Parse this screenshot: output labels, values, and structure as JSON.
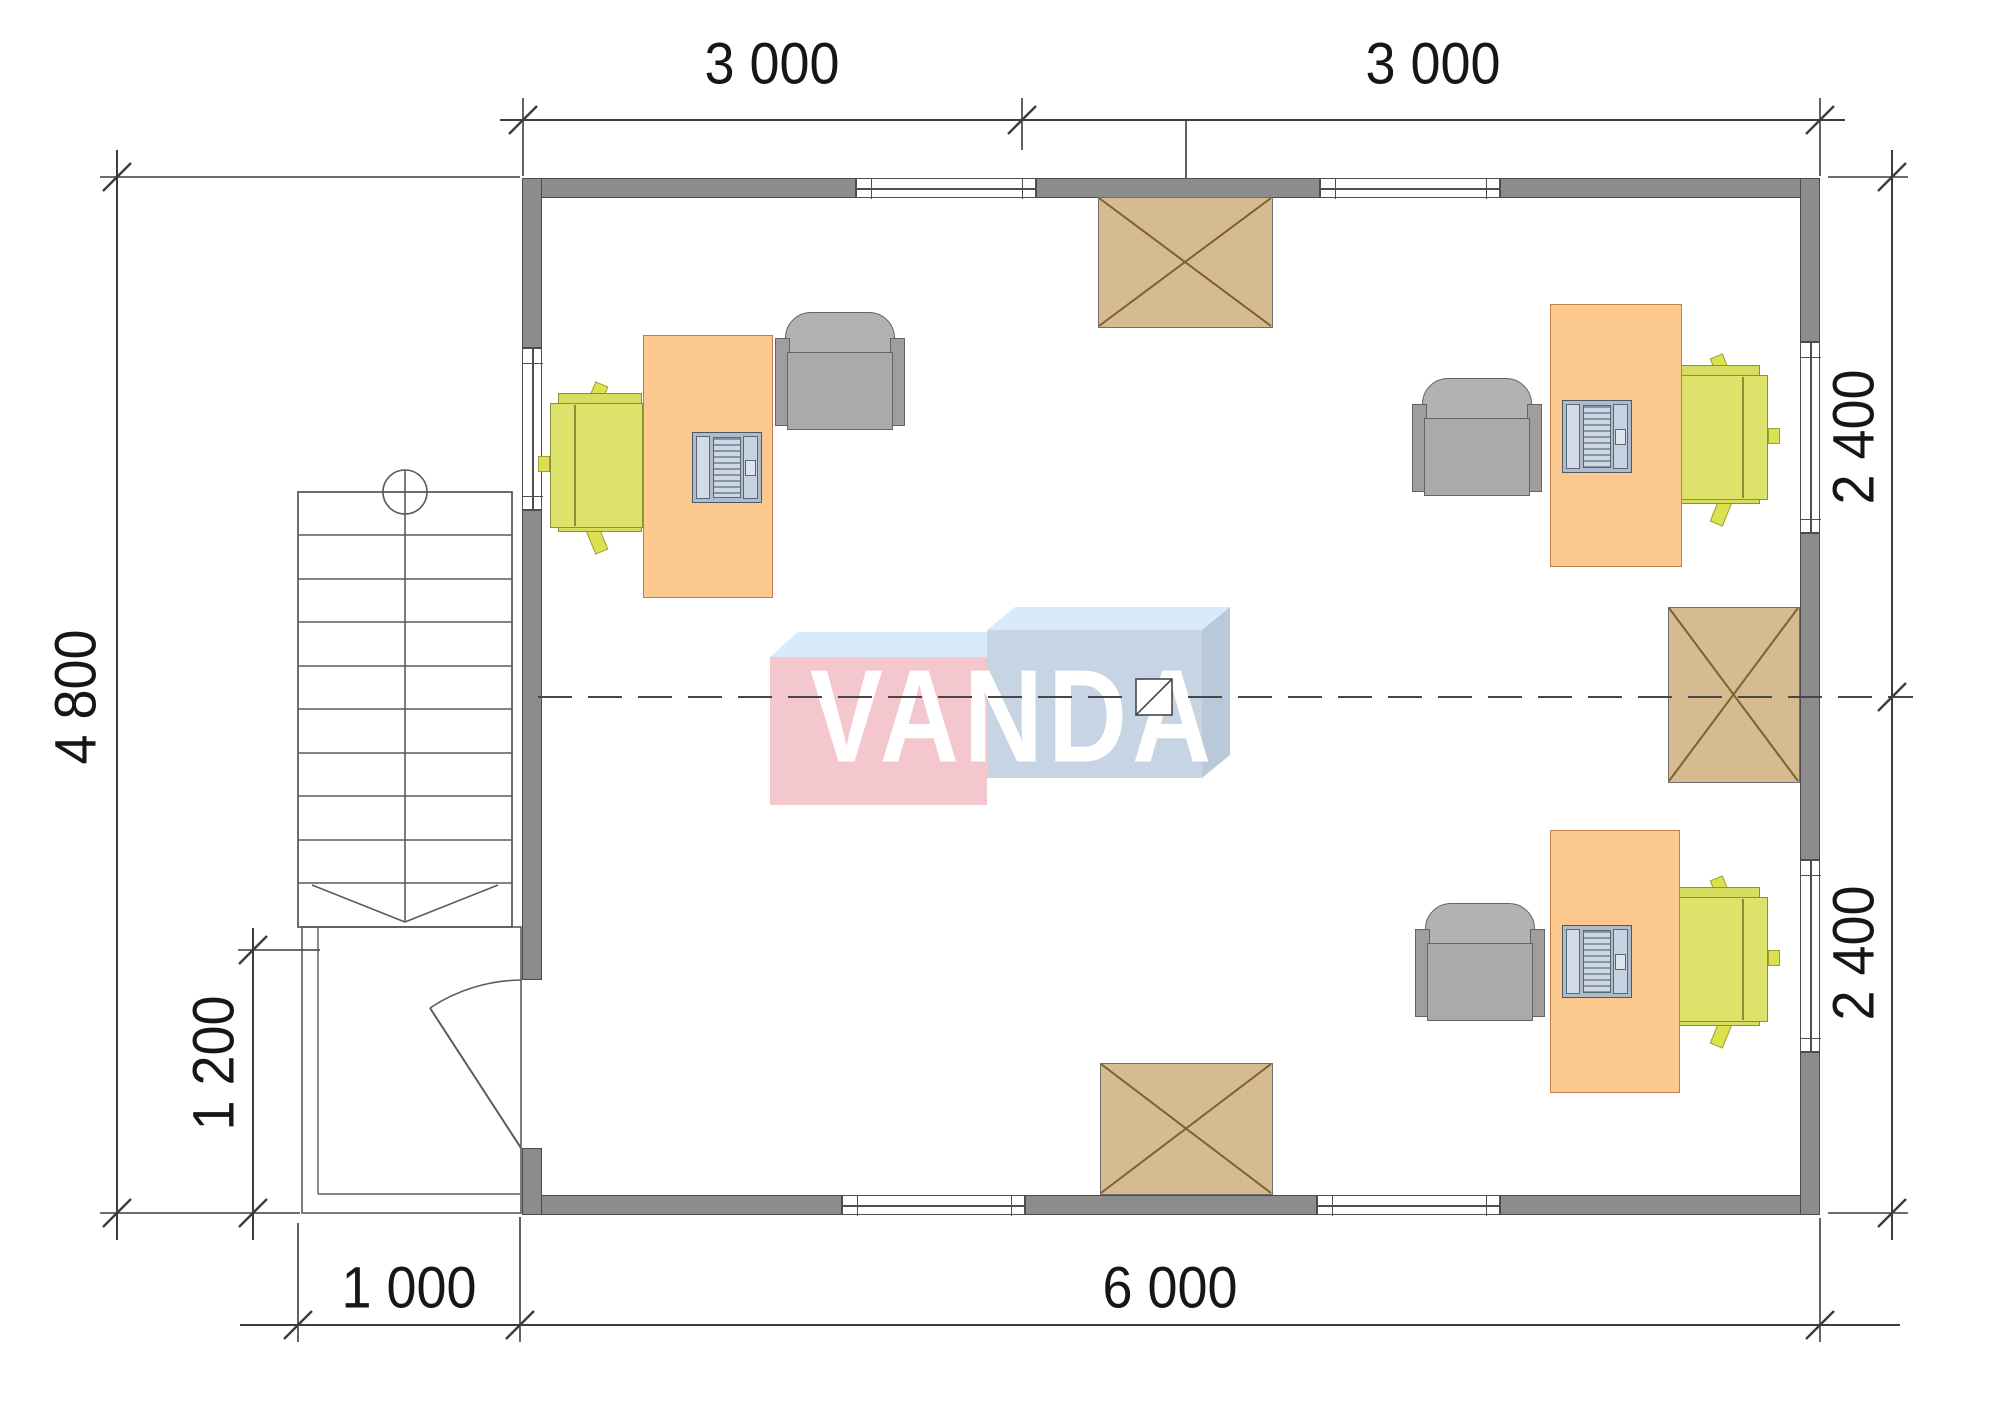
{
  "logo": {
    "text": "VANDA",
    "center": [
      1013,
      722
    ],
    "pink_front": "#f3c7cd",
    "pink_top": "#d7ebf8",
    "blue_front": "#c6d4e3",
    "blue_top": "#d7ecf8",
    "blue_side": "#b9c9da",
    "text_color": "#ffffff",
    "polys": {
      "pink_front": [
        [
          770,
          657
        ],
        [
          987,
          657
        ],
        [
          987,
          805
        ],
        [
          770,
          805
        ]
      ],
      "pink_top": [
        [
          770,
          657
        ],
        [
          987,
          657
        ],
        [
          1015,
          632
        ],
        [
          798,
          632
        ]
      ],
      "blue_front": [
        [
          987,
          630
        ],
        [
          1202,
          630
        ],
        [
          1202,
          778
        ],
        [
          987,
          778
        ]
      ],
      "blue_top": [
        [
          987,
          630
        ],
        [
          1202,
          630
        ],
        [
          1230,
          607
        ],
        [
          1015,
          607
        ]
      ],
      "blue_side": [
        [
          1202,
          630
        ],
        [
          1230,
          607
        ],
        [
          1230,
          755
        ],
        [
          1202,
          778
        ]
      ]
    }
  },
  "dimensions": {
    "labels": [
      {
        "text": "3 000",
        "x": 772,
        "y": 64,
        "rot": false
      },
      {
        "text": "3 000",
        "x": 1433,
        "y": 64,
        "rot": false
      },
      {
        "text": "4 800",
        "x": 76,
        "y": 697,
        "rot": true
      },
      {
        "text": "1 200",
        "x": 214,
        "y": 1063,
        "rot": true
      },
      {
        "text": "1 000",
        "x": 409,
        "y": 1288,
        "rot": false
      },
      {
        "text": "6 000",
        "x": 1170,
        "y": 1288,
        "rot": false
      },
      {
        "text": "2 400",
        "x": 1854,
        "y": 437,
        "rot": true
      },
      {
        "text": "2 400",
        "x": 1854,
        "y": 953,
        "rot": true
      }
    ],
    "dim_lines": [
      [
        500,
        120,
        1845,
        120
      ],
      [
        117,
        150,
        117,
        1240
      ],
      [
        253,
        928,
        253,
        1240
      ],
      [
        240,
        1325,
        1900,
        1325
      ],
      [
        1892,
        150,
        1892,
        1240
      ]
    ],
    "ticks": [
      [
        523,
        120
      ],
      [
        1022,
        120
      ],
      [
        1820,
        120
      ],
      [
        117,
        177
      ],
      [
        117,
        1213
      ],
      [
        253,
        950
      ],
      [
        253,
        1213
      ],
      [
        298,
        1325
      ],
      [
        520,
        1325
      ],
      [
        1820,
        1325
      ],
      [
        1892,
        177
      ],
      [
        1892,
        697
      ],
      [
        1892,
        1213
      ]
    ],
    "ext_lines": [
      [
        523,
        98,
        523,
        176
      ],
      [
        1022,
        98,
        1022,
        150
      ],
      [
        1186,
        120,
        1186,
        178
      ],
      [
        1820,
        98,
        1820,
        176
      ],
      [
        100,
        177,
        520,
        177
      ],
      [
        100,
        1213,
        300,
        1213
      ],
      [
        238,
        950,
        320,
        950
      ],
      [
        298,
        1223,
        298,
        1342
      ],
      [
        520,
        1217,
        520,
        1342
      ],
      [
        1820,
        1218,
        1820,
        1342
      ],
      [
        1828,
        177,
        1908,
        177
      ],
      [
        1828,
        1213,
        1908,
        1213
      ]
    ]
  },
  "plan": {
    "walls": [
      {
        "name": "top-wall-left",
        "r": [
          522,
          178,
          334,
          20
        ]
      },
      {
        "name": "top-wall-mid",
        "r": [
          1036,
          178,
          284,
          20
        ]
      },
      {
        "name": "top-wall-right",
        "r": [
          1500,
          178,
          320,
          20
        ]
      },
      {
        "name": "bottom-wall-left",
        "r": [
          522,
          1195,
          320,
          20
        ]
      },
      {
        "name": "bottom-wall-mid",
        "r": [
          1025,
          1195,
          292,
          20
        ]
      },
      {
        "name": "bottom-wall-right",
        "r": [
          1500,
          1195,
          320,
          20
        ]
      },
      {
        "name": "left-wall-top",
        "r": [
          522,
          178,
          20,
          170
        ]
      },
      {
        "name": "left-wall-mid",
        "r": [
          522,
          510,
          20,
          470
        ]
      },
      {
        "name": "left-wall-bottom",
        "r": [
          522,
          1148,
          20,
          67
        ]
      },
      {
        "name": "right-wall-top",
        "r": [
          1800,
          178,
          20,
          164
        ]
      },
      {
        "name": "right-wall-mid",
        "r": [
          1800,
          533,
          20,
          327
        ]
      },
      {
        "name": "right-wall-bottom",
        "r": [
          1800,
          1052,
          20,
          163
        ]
      }
    ],
    "windows": [
      {
        "name": "window-top-1",
        "r": [
          856,
          178,
          180,
          20
        ],
        "orient": "h"
      },
      {
        "name": "window-top-2",
        "r": [
          1320,
          178,
          180,
          20
        ],
        "orient": "h"
      },
      {
        "name": "window-bottom-1",
        "r": [
          842,
          1195,
          183,
          20
        ],
        "orient": "h"
      },
      {
        "name": "window-bottom-2",
        "r": [
          1317,
          1195,
          183,
          20
        ],
        "orient": "h"
      },
      {
        "name": "window-left",
        "r": [
          522,
          348,
          20,
          162
        ],
        "orient": "v"
      },
      {
        "name": "window-right-1",
        "r": [
          1800,
          342,
          20,
          191
        ],
        "orient": "v"
      },
      {
        "name": "window-right-2",
        "r": [
          1800,
          860,
          20,
          192
        ],
        "orient": "v"
      }
    ],
    "hatches": [
      {
        "name": "roof-hatch-top",
        "r": [
          1098,
          197,
          175,
          131
        ]
      },
      {
        "name": "roof-hatch-right",
        "r": [
          1668,
          607,
          132,
          176
        ]
      },
      {
        "name": "roof-hatch-bottom",
        "r": [
          1100,
          1063,
          173,
          132
        ]
      }
    ],
    "workstations": [
      {
        "id": "workstation-top-left",
        "desk": [
          643,
          335,
          130,
          263
        ],
        "laptop": [
          692,
          432,
          70,
          71
        ],
        "chair": [
          540,
          385
        ],
        "mirror": false,
        "armchair": [
          775,
          312
        ]
      },
      {
        "id": "workstation-top-right",
        "desk": [
          1550,
          304,
          132,
          263
        ],
        "laptop": [
          1562,
          400,
          70,
          73
        ],
        "chair": [
          1668,
          357
        ],
        "mirror": true,
        "armchair": [
          1412,
          378
        ]
      },
      {
        "id": "workstation-bottom-right",
        "desk": [
          1550,
          830,
          130,
          263
        ],
        "laptop": [
          1562,
          925,
          70,
          73
        ],
        "chair": [
          1668,
          879
        ],
        "mirror": true,
        "armchair": [
          1415,
          903
        ]
      }
    ],
    "stairs": {
      "rect": [
        298,
        492,
        214,
        435
      ],
      "tread_ys": [
        535,
        579,
        622,
        666,
        709,
        753,
        796,
        840,
        883
      ],
      "walk_x": 405,
      "circle": [
        405,
        492,
        22
      ],
      "arrow": [
        [
          312,
          885
        ],
        [
          405,
          922
        ],
        [
          498,
          885
        ]
      ]
    },
    "porch": {
      "outer": [
        302,
        927,
        219,
        286
      ],
      "inner_v": [
        318,
        927,
        318,
        1194
      ],
      "inner_h": [
        318,
        1194,
        520,
        1194
      ]
    },
    "door": {
      "leaf": [
        521,
        1148,
        430,
        1008
      ],
      "arc": "M521,980 A168,168 0 0 0 430,1008"
    },
    "centerline": {
      "y": 697,
      "x1": 538,
      "x2": 1913,
      "dash": "34 16",
      "marker": {
        "r": [
          1136,
          679,
          36,
          36
        ],
        "diag": [
          1136,
          715,
          1172,
          679
        ]
      }
    }
  },
  "colors": {
    "wall": "#8c8c8c",
    "wall_outline": "#4a4a4a",
    "desk": "#fbc98d",
    "chair_green": "#dce26a",
    "armchair_gray": "#aaaaaa",
    "hatch_tan": "#d6ba90",
    "hatch_cross": "#7c6134",
    "line": "#3c3c3c",
    "thin_line": "#5c5c5c",
    "text": "#161616",
    "background": "#ffffff"
  }
}
